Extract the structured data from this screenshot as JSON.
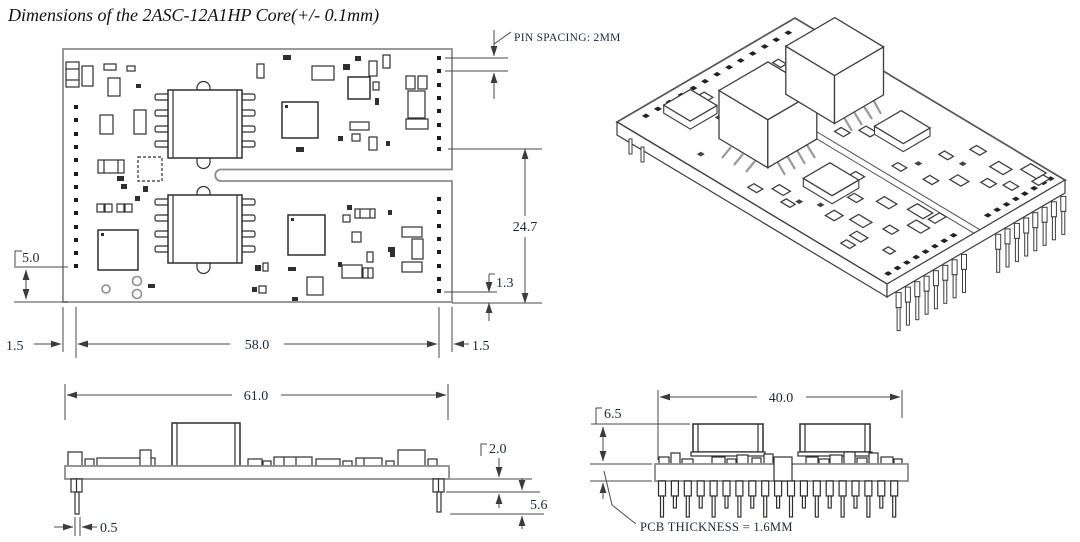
{
  "title": "Dimensions of the 2ASC-12A1HP Core(+/- 0.1mm)",
  "top_view": {
    "pin_spacing_label": "PIN SPACING: 2MM",
    "dim_pin_rows_to_bottom_edge": "24.7",
    "dim_last_pin_to_edge_right": "1.3",
    "dim_last_pin_to_edge_left": "5.0",
    "dim_edge_to_pin_left": "1.5",
    "dim_pin_row_span": "58.0",
    "dim_pin_to_edge_right": "1.5"
  },
  "front_view": {
    "dim_overall_length": "61.0",
    "dim_standoff_height": "2.0",
    "dim_pin_length": "5.6",
    "dim_pin_width": "0.5"
  },
  "end_view": {
    "dim_component_height": "6.5",
    "dim_overall_width": "40.0",
    "pcb_thickness_label": "PCB THICKNESS = 1.6MM"
  },
  "colors": {
    "background": "#ffffff",
    "line": "#4a4a4a",
    "board_outline": "#8c8c8c",
    "component_line": "#2f2f2f",
    "dim_text": "#1e2836"
  }
}
